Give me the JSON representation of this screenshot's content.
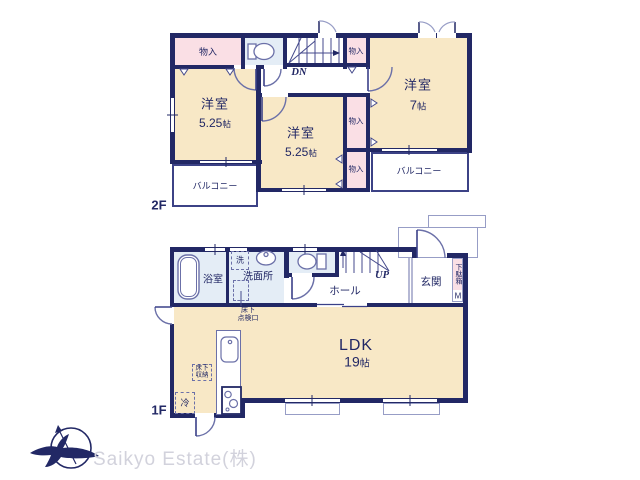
{
  "colors": {
    "wall": "#222865",
    "room_fill": "#f8e8c6",
    "closet_fill": "#fadfe5",
    "wet_area_fill": "#e4edf6",
    "fixture_line": "#6b70a8",
    "watermark": "#d2d2dc"
  },
  "floor2": {
    "label": "2F",
    "room_west": {
      "name": "洋室",
      "size_num": "5.25",
      "size_unit": "帖"
    },
    "room_center": {
      "name": "洋室",
      "size_num": "5.25",
      "size_unit": "帖"
    },
    "room_east": {
      "name": "洋室",
      "size_num": "7",
      "size_unit": "帖"
    },
    "closet_top_west": "物入",
    "closet_top_east": "物入",
    "closet_mid_east": "物入",
    "closet_south_east": "物入",
    "balcony_west": "バルコニー",
    "balcony_east": "バルコニー",
    "stair_direction": "DN"
  },
  "floor1": {
    "label": "1F",
    "ldk": {
      "name": "LDK",
      "size_num": "19",
      "size_unit": "帖"
    },
    "bath": "浴室",
    "washroom": "洗面所",
    "washing_machine": "洗",
    "hall": "ホール",
    "stair_direction": "UP",
    "entrance": "玄関",
    "shoe_cabinet": "下駄箱",
    "shoe_cabinet_size": "M",
    "underfloor_hatch_line1": "床下",
    "underfloor_hatch_line2": "点検口",
    "underfloor_storage_line1": "床下",
    "underfloor_storage_line2": "収納",
    "refrigerator": "冷"
  },
  "logo": {
    "company": "Saikyo Estate(株)"
  }
}
